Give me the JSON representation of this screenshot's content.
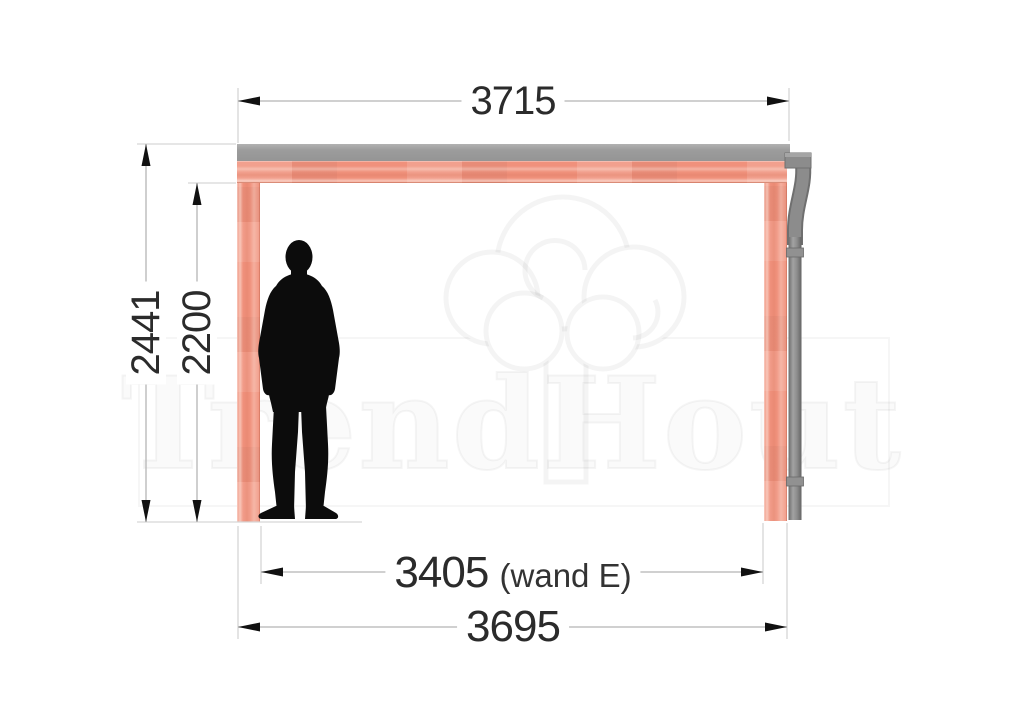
{
  "title": "Veranda side-view technical drawing",
  "watermark": {
    "brand": "TrendHout"
  },
  "dimensions": {
    "top_width": {
      "value": "3715"
    },
    "outer_height": {
      "value": "2441"
    },
    "inner_height": {
      "value": "2200"
    },
    "wall_width": {
      "value": "3405",
      "suffix": "(wand E)"
    },
    "bottom_width": {
      "value": "3695"
    }
  },
  "icons": {
    "person": "standing-man-silhouette",
    "logo": "trendhout-tree-logo",
    "downspout": "gutter-downpipe"
  },
  "colors": {
    "wood": "#f0917c",
    "roof_gray": "#9b9b9b",
    "pipe_gray": "#8a8a8a",
    "dimension_line": "#b5b5b5",
    "extension_line": "#d6d6d6",
    "arrow": "#111111",
    "text": "#2b2b2b"
  }
}
